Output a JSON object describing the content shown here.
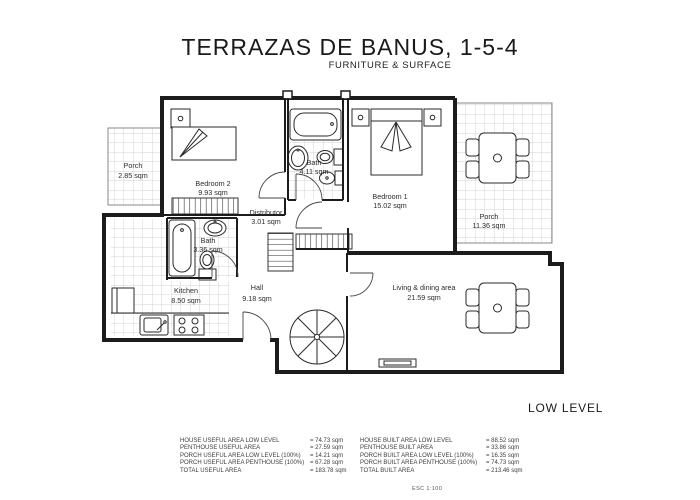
{
  "header": {
    "title": "TERRAZAS DE BANUS, 1-5-4",
    "subtitle": "FURNITURE & SURFACE"
  },
  "plan": {
    "level_label": "LOW LEVEL",
    "scale_label": "ESC 1:100"
  },
  "rooms": {
    "porch_left": {
      "name": "Porch",
      "area": "2.85 sqm"
    },
    "bedroom2": {
      "name": "Bedroom 2",
      "area": "9.93 sqm"
    },
    "bath_top": {
      "name": "Bath",
      "area": "4.11 sqm"
    },
    "bedroom1": {
      "name": "Bedroom 1",
      "area": "15.02 sqm"
    },
    "porch_right": {
      "name": "Porch",
      "area": "11.36 sqm"
    },
    "distributor": {
      "name": "Distributor",
      "area": "3.01 sqm"
    },
    "bath_low": {
      "name": "Bath",
      "area": "3.36 sqm"
    },
    "kitchen": {
      "name": "Kitchen",
      "area": "8.50 sqm"
    },
    "hall": {
      "name": "Hall",
      "area": "9.18 sqm"
    },
    "living": {
      "name": "Living & dining area",
      "area": "21.59 sqm"
    }
  },
  "area_table": {
    "rows": [
      {
        "l": "HOUSE USEFUL AREA LOW LEVEL",
        "lv": "= 74.73 sqm",
        "r": "HOUSE BUILT AREA LOW LEVEL",
        "rv": "= 88.52 sqm"
      },
      {
        "l": "PENTHOUSE USEFUL AREA",
        "lv": "= 27.59 sqm",
        "r": "PENTHOUSE BUILT AREA",
        "rv": "= 33.86 sqm"
      },
      {
        "l": "PORCH USEFUL AREA LOW LEVEL (100%)",
        "lv": "= 14.21 sqm",
        "r": "PORCH BUILT AREA LOW LEVEL (100%)",
        "rv": "= 16.35 sqm"
      },
      {
        "l": "PORCH USEFUL AREA PENTHOUSE (100%)",
        "lv": "= 67.28 sqm",
        "r": "PORCH BUILT AREA PENTHOUSE (100%)",
        "rv": "= 74.73 sqm"
      },
      {
        "l": "TOTAL USEFUL AREA",
        "lv": "= 183.78 sqm",
        "r": "TOTAL BUILT AREA",
        "rv": "= 213.46 sqm"
      }
    ]
  },
  "colors": {
    "wall": "#1c1c1c",
    "tile_line": "#c4c4c4",
    "text": "#2b2b2b"
  }
}
